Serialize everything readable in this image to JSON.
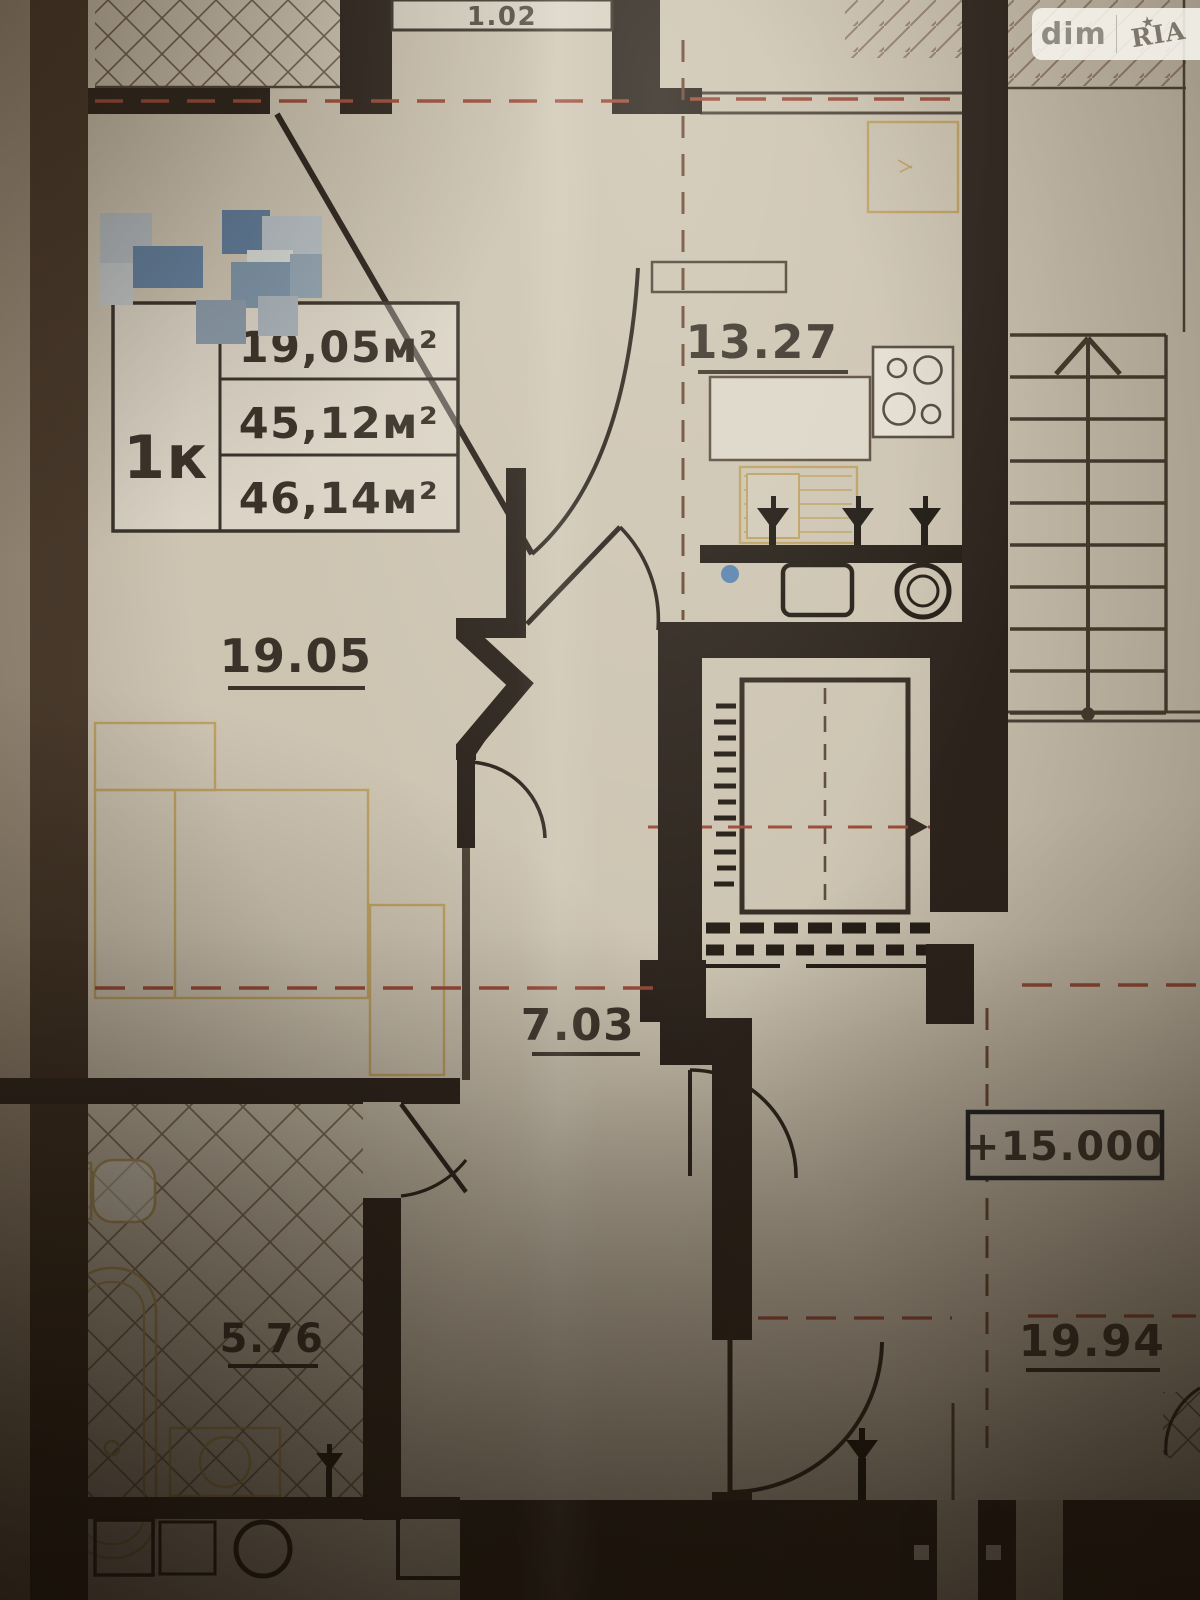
{
  "document_type": "apartment-floor-plan-photo",
  "watermark": {
    "left": "dim",
    "right": "RIA",
    "star": "★"
  },
  "top_label": "1.02",
  "unit_info": {
    "type_label": "1к",
    "rows": [
      "19,05м²",
      "45,12м²",
      "46,14м²"
    ]
  },
  "rooms": [
    {
      "id": "kitchen",
      "area_label": "13.27"
    },
    {
      "id": "living-room",
      "area_label": "19.05"
    },
    {
      "id": "hallway",
      "area_label": "7.03"
    },
    {
      "id": "bathroom",
      "area_label": "5.76"
    },
    {
      "id": "neighbor-room",
      "area_label": "19.94"
    }
  ],
  "elevation_marker": "+15.000",
  "colors": {
    "paper": "#cdc4b2",
    "wall_dark": "#2b231c",
    "accent_blue": "#4c7cb4",
    "axis_red": "#9a4a38",
    "axis_brown": "#6b4a33",
    "furniture_yellow": "#bb9c55"
  }
}
